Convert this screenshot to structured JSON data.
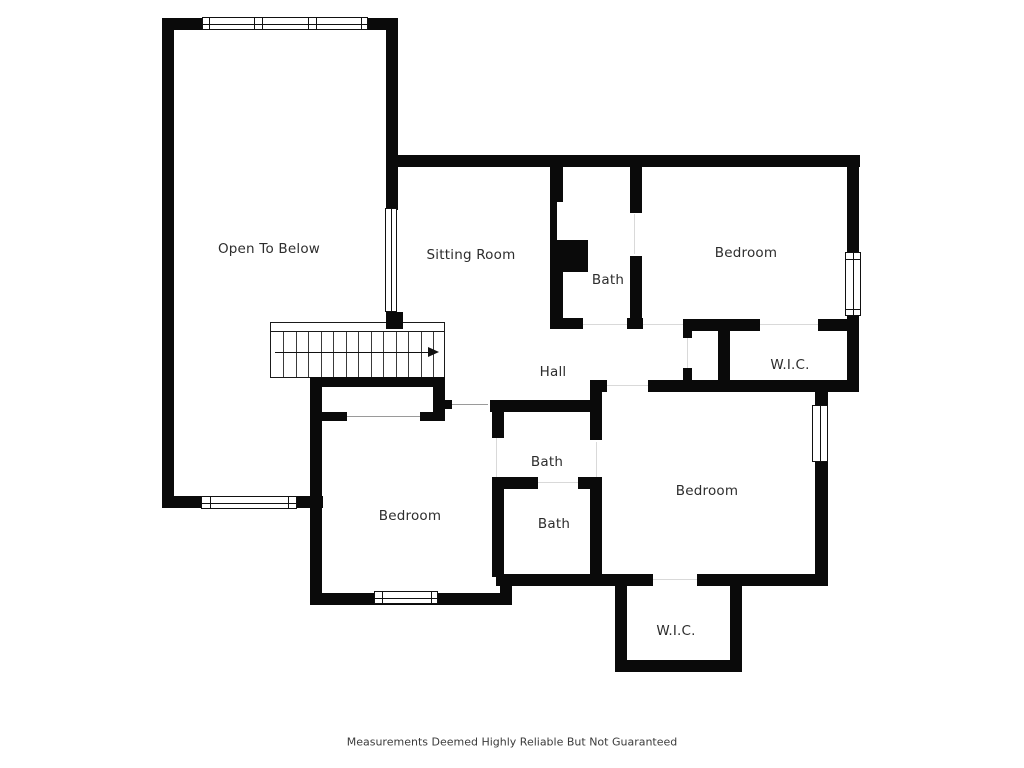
{
  "page": {
    "background": "#ffffff"
  },
  "floor_plan": {
    "type": "residential-second-floor",
    "rooms": [
      {
        "id": "open-to-below",
        "label": "Open To Below"
      },
      {
        "id": "sitting-room",
        "label": "Sitting Room"
      },
      {
        "id": "bath-upper",
        "label": "Bath"
      },
      {
        "id": "bedroom-upper-right",
        "label": "Bedroom"
      },
      {
        "id": "wic-upper",
        "label": "W.I.C."
      },
      {
        "id": "hall",
        "label": "Hall"
      },
      {
        "id": "bath-middle",
        "label": "Bath"
      },
      {
        "id": "bath-lower",
        "label": "Bath"
      },
      {
        "id": "bedroom-lower-left",
        "label": "Bedroom"
      },
      {
        "id": "bedroom-lower-right",
        "label": "Bedroom"
      },
      {
        "id": "wic-lower",
        "label": "W.I.C."
      }
    ],
    "stairs": {
      "treads": 13,
      "direction_arrow": "right"
    },
    "window_count": 6,
    "colors": {
      "wall": "#0a0a0a",
      "label_text": "#2d2d2d",
      "door_swing_line": "#9a9a9a"
    },
    "disclaimer": "Measurements Deemed Highly Reliable But Not Guaranteed"
  }
}
